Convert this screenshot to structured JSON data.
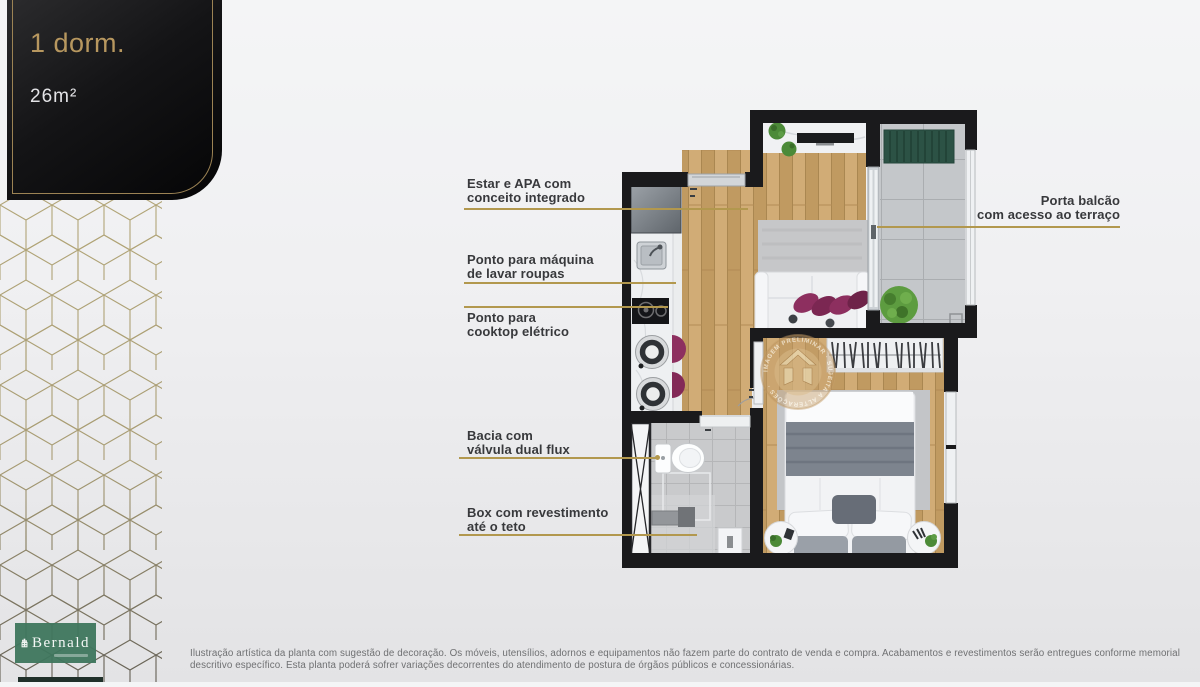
{
  "badge": {
    "title": "1 dorm.",
    "area": "26m²"
  },
  "brand": {
    "name": "Bernald"
  },
  "callouts": {
    "estar": {
      "line1": "Estar e APA com",
      "line2": "conceito integrado"
    },
    "maquina": {
      "line1": "Ponto para máquina",
      "line2": "de lavar roupas"
    },
    "cooktop": {
      "line1": "Ponto para",
      "line2": "cooktop elétrico"
    },
    "bacia": {
      "line1": "Bacia com",
      "line2": "válvula dual flux"
    },
    "box": {
      "line1": "Box com revestimento",
      "line2": "até o teto"
    },
    "balcao": {
      "line1": "Porta balcão",
      "line2": "com acesso ao terraço"
    }
  },
  "watermark": {
    "ring_text": "IMAGEM PRELIMINAR · SUJEITA A ALTERAÇÕES ·"
  },
  "disclaimer": "Ilustração artística da planta com sugestão de decoração. Os móveis, utensílios, adornos e equipamentos não fazem parte do contrato de venda e compra. Acabamentos e revestimentos serão entregues conforme memorial descritivo específico. Esta planta poderá sofrer variações decorrentes do atendimento de postura de órgãos públicos e concessionárias.",
  "colors": {
    "accent_gold": "#b2984e",
    "badge_gold": "#b7975f",
    "brand_green": "#3e765d",
    "wall_black": "#1a1a1c",
    "wood": "#c9a46d",
    "pillow_purple": "#8d2f5f",
    "terrace_green": "#2c5245"
  }
}
